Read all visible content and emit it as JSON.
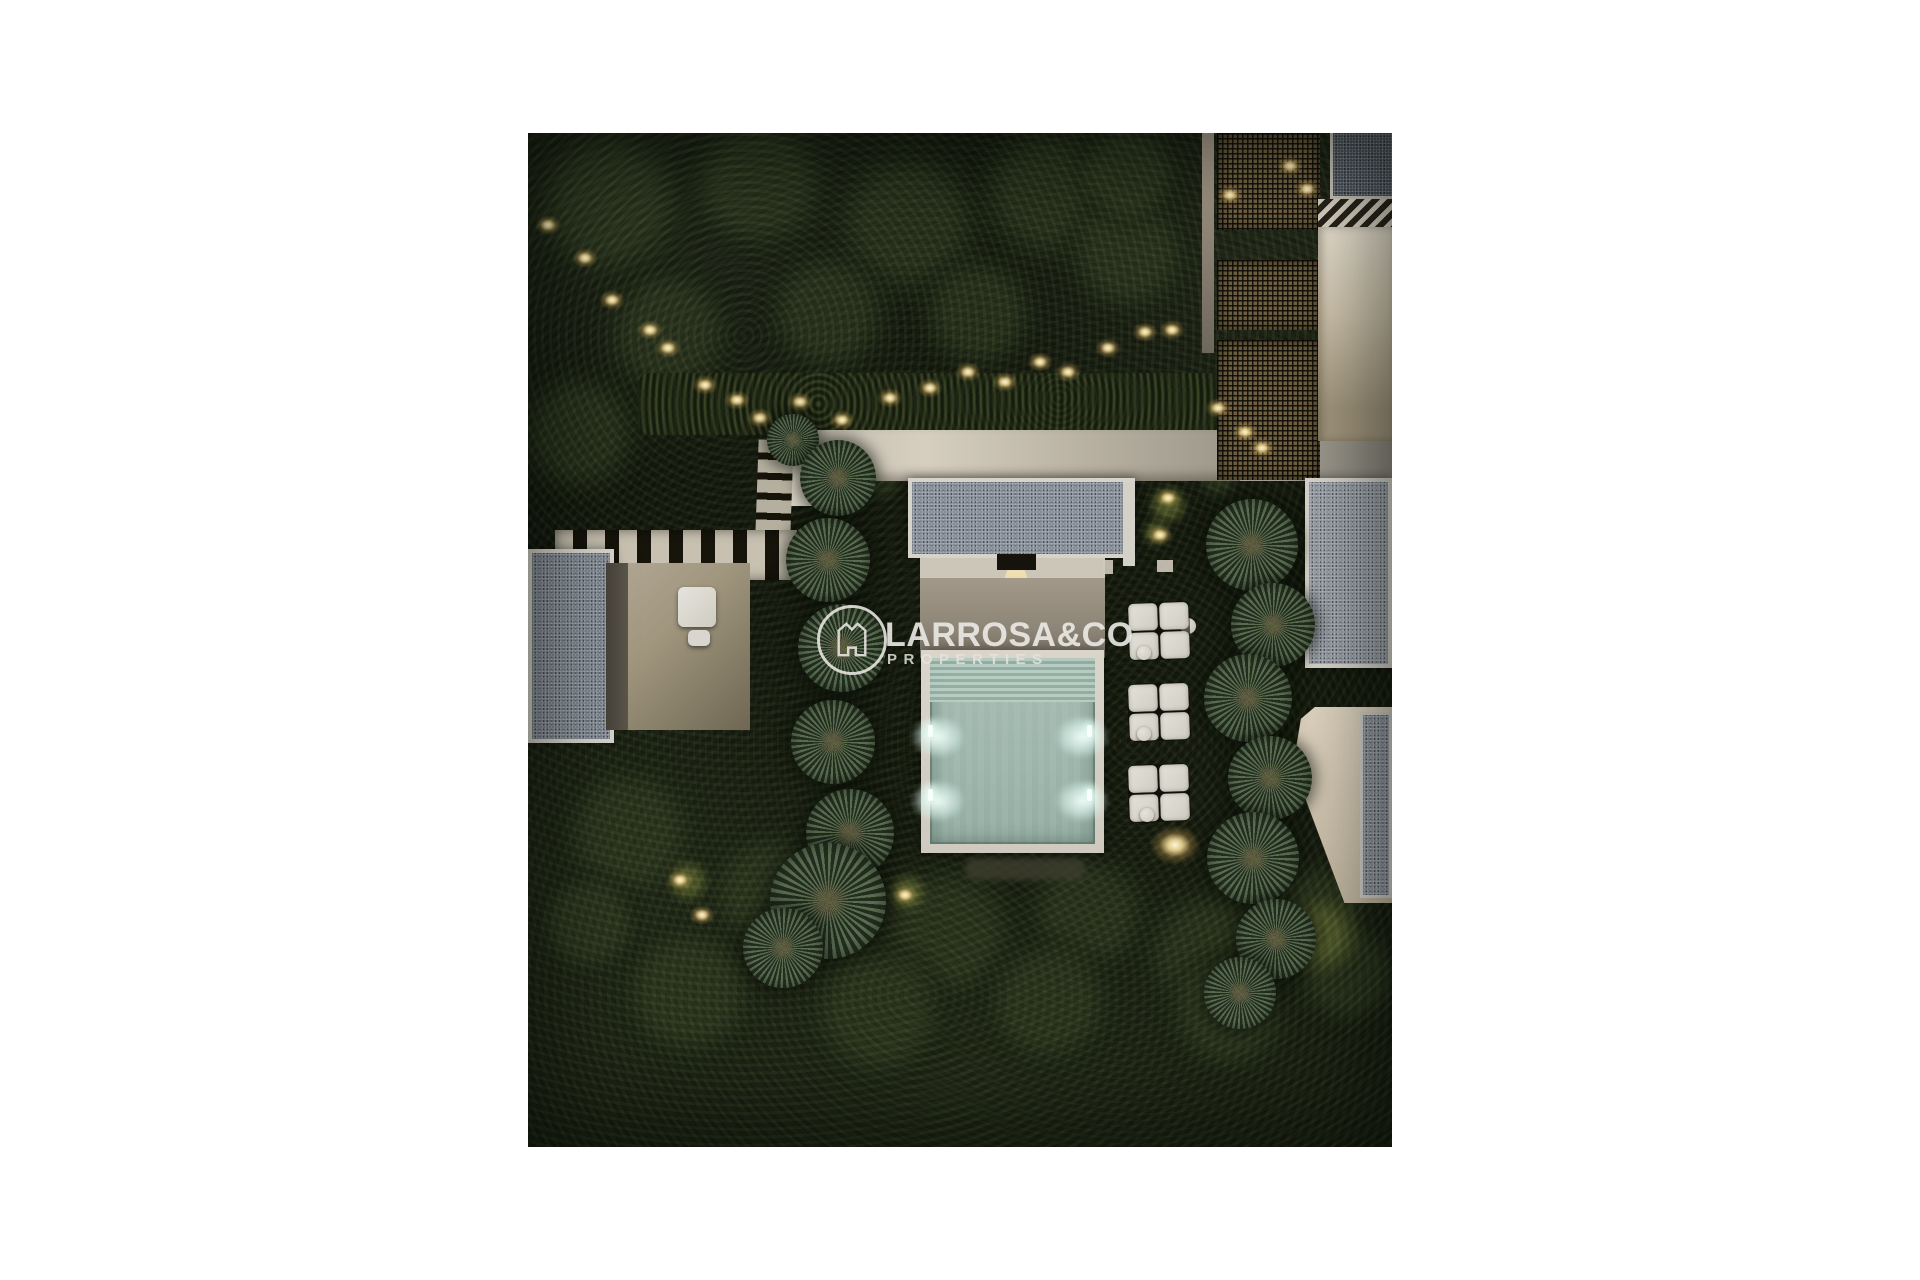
{
  "page": {
    "background_color": "#ffffff"
  },
  "watermark": {
    "brand": "LARROSA&CO",
    "tagline": "PROPERTIES",
    "icon": "house-crown-in-circle",
    "text_color": "rgba(236,234,229,0.94)"
  },
  "scene": {
    "description": "Night-time aerial 3D render of a modern villa garden: illuminated turquoise pool with four underwater lights, white deck, grey gravel flat roofs with white fascias, beige lit terraces, lattice pergola, palm trees in two columns, white modular lounge sofas and warm landscape lighting in dark vegetation.",
    "palette": {
      "canvas": "#ffffff",
      "foliage_dark": "#14180d",
      "foliage_light": "#2a331e",
      "roof_gravel": "#868d97",
      "deck_white": "#d8d4ca",
      "terrace_beige": "#a3998a",
      "pool_water": "#a3bab0",
      "warm_light": "#ffe9b4"
    },
    "bushes": [
      [
        80,
        70,
        90
      ],
      [
        230,
        50,
        80
      ],
      [
        380,
        90,
        85
      ],
      [
        520,
        60,
        80
      ],
      [
        300,
        180,
        70
      ],
      [
        140,
        200,
        75
      ],
      [
        450,
        180,
        65
      ],
      [
        600,
        120,
        70
      ],
      [
        50,
        300,
        70
      ],
      [
        600,
        40,
        60
      ],
      [
        100,
        700,
        80
      ],
      [
        240,
        760,
        70
      ],
      [
        420,
        800,
        80
      ],
      [
        560,
        780,
        70
      ],
      [
        680,
        820,
        75
      ],
      [
        790,
        780,
        60
      ],
      [
        160,
        860,
        80
      ],
      [
        350,
        880,
        80
      ],
      [
        520,
        870,
        75
      ],
      [
        700,
        880,
        70
      ],
      [
        60,
        790,
        60
      ],
      [
        820,
        840,
        60
      ],
      [
        300,
        332,
        30
      ],
      [
        352,
        345,
        26
      ],
      [
        418,
        332,
        26
      ],
      [
        468,
        341,
        22
      ],
      [
        522,
        333,
        21
      ],
      [
        560,
        342,
        18
      ],
      [
        712,
        318,
        26
      ],
      [
        690,
        345,
        22
      ],
      [
        810,
        300,
        40
      ]
    ],
    "lit_bushes": [
      [
        640,
        372,
        20
      ],
      [
        628,
        400,
        14
      ],
      [
        160,
        748,
        22
      ],
      [
        380,
        760,
        20
      ],
      [
        792,
        802,
        42
      ]
    ],
    "palms": [
      [
        265,
        307,
        26
      ],
      [
        310,
        345,
        38
      ],
      [
        300,
        427,
        42
      ],
      [
        314,
        515,
        44
      ],
      [
        305,
        609,
        42
      ],
      [
        322,
        700,
        44
      ],
      [
        300,
        768,
        58
      ],
      [
        255,
        815,
        40
      ],
      [
        724,
        412,
        46
      ],
      [
        745,
        492,
        42
      ],
      [
        720,
        565,
        44
      ],
      [
        742,
        645,
        42
      ],
      [
        725,
        725,
        46
      ],
      [
        748,
        806,
        40
      ],
      [
        712,
        860,
        36
      ]
    ],
    "garden_lights": [
      [
        20,
        92
      ],
      [
        57,
        125
      ],
      [
        84,
        167
      ],
      [
        122,
        197
      ],
      [
        140,
        215
      ],
      [
        177,
        252
      ],
      [
        209,
        267
      ],
      [
        232,
        285
      ],
      [
        272,
        269
      ],
      [
        314,
        287
      ],
      [
        362,
        265
      ],
      [
        402,
        255
      ],
      [
        440,
        239
      ],
      [
        477,
        249
      ],
      [
        512,
        229
      ],
      [
        540,
        239
      ],
      [
        580,
        215
      ],
      [
        617,
        199
      ],
      [
        644,
        197
      ],
      [
        690,
        275
      ],
      [
        702,
        62
      ],
      [
        762,
        33
      ],
      [
        779,
        56
      ],
      [
        717,
        299
      ],
      [
        734,
        315
      ],
      [
        640,
        365
      ],
      [
        632,
        402
      ],
      [
        152,
        747
      ],
      [
        174,
        782
      ],
      [
        377,
        762
      ]
    ],
    "big_lights": [
      [
        647,
        712
      ]
    ],
    "pool_glows": [
      [
        410,
        604
      ],
      [
        554,
        604
      ],
      [
        410,
        668
      ],
      [
        554,
        668
      ]
    ],
    "pool_fixtures": [
      [
        402,
        598
      ],
      [
        561,
        598
      ],
      [
        402,
        662
      ],
      [
        561,
        662
      ]
    ],
    "sofa_groups": [
      [
        600,
        469
      ],
      [
        600,
        550
      ],
      [
        600,
        631
      ]
    ],
    "side_tables": [
      [
        616,
        520
      ],
      [
        616,
        601
      ],
      [
        619,
        682
      ]
    ]
  }
}
